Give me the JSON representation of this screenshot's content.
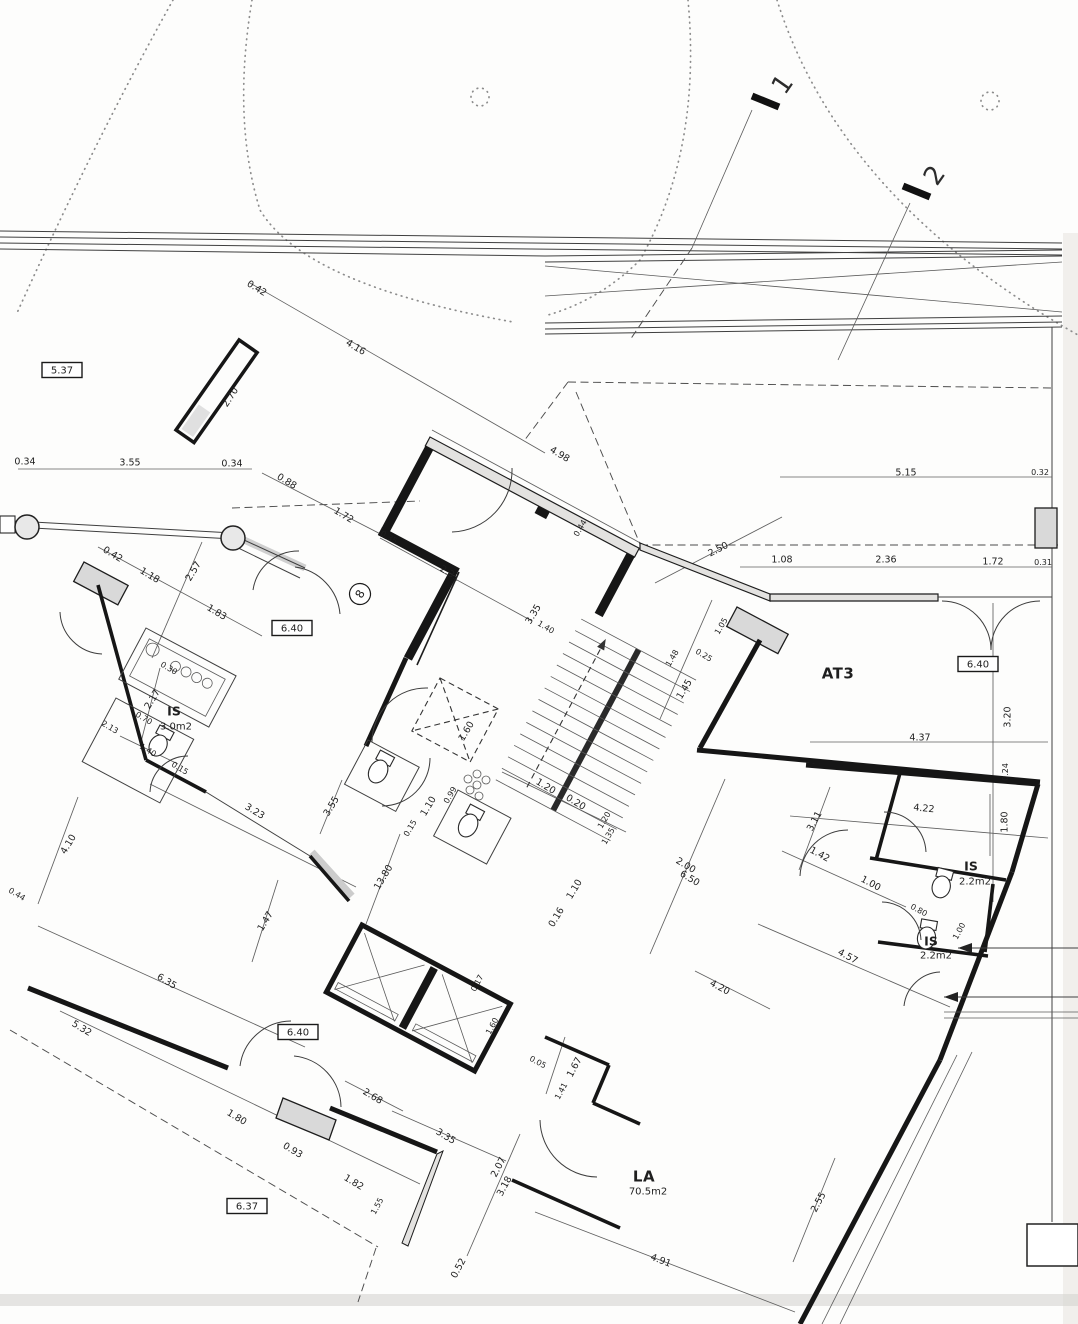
{
  "document": {
    "kind": "scanned architectural floor plan",
    "sheet_note": "rotated building plan with dimension chains in meters"
  },
  "rooms": [
    {
      "name": "AT3",
      "area": ""
    },
    {
      "name": "LA",
      "area": "70.5m2"
    },
    {
      "name": "IS",
      "area": "3.0m2"
    },
    {
      "name": "IS",
      "area": "2.2m2"
    },
    {
      "name": "IS",
      "area": "2.2m2"
    }
  ],
  "level_markers": [
    "5.37",
    "6.40",
    "6.40",
    "6.40",
    "6.37"
  ],
  "section_markers": [
    "1",
    "2"
  ],
  "grid_bubbles": [
    "8"
  ],
  "label_styles": {
    "d": {
      "cls": "lbl-d"
    },
    "ds": {
      "cls": "lbl-ds"
    },
    "rm": {
      "cls": "lbl-rm"
    },
    "rm2": {
      "cls": "lbl-rm2"
    },
    "ar": {
      "cls": "lbl-ar"
    },
    "bx": {
      "cls": "lbl-bx",
      "box": [
        40,
        15
      ]
    },
    "mk": {
      "cls": "lbl-mk"
    },
    "bb": {
      "cls": "lbl-bb",
      "circle": 10.5
    }
  },
  "labels": [
    {
      "t": "5.37",
      "x": 62,
      "y": 370,
      "r": 0,
      "s": "bx",
      "n": "level-label"
    },
    {
      "t": "0.42",
      "x": 257,
      "y": 288,
      "r": 31,
      "s": "d",
      "n": "dim-label"
    },
    {
      "t": "4.16",
      "x": 356,
      "y": 347,
      "r": 31,
      "s": "d",
      "n": "dim-label"
    },
    {
      "t": "2.70",
      "x": 230,
      "y": 397,
      "r": -57,
      "s": "d",
      "n": "dim-label"
    },
    {
      "t": "1",
      "x": 782,
      "y": 84,
      "r": -55,
      "s": "mk",
      "n": "section-marker"
    },
    {
      "t": "2",
      "x": 934,
      "y": 175,
      "r": -55,
      "s": "mk",
      "n": "section-marker"
    },
    {
      "t": "0.34",
      "x": 25,
      "y": 461,
      "r": 0,
      "s": "d",
      "n": "dim-label"
    },
    {
      "t": "3.55",
      "x": 130,
      "y": 462,
      "r": 0,
      "s": "d",
      "n": "dim-label"
    },
    {
      "t": "0.34",
      "x": 232,
      "y": 463,
      "r": 0,
      "s": "d",
      "n": "dim-label"
    },
    {
      "t": "0.88",
      "x": 287,
      "y": 481,
      "r": 31,
      "s": "d",
      "n": "dim-label"
    },
    {
      "t": "1.72",
      "x": 344,
      "y": 515,
      "r": 31,
      "s": "d",
      "n": "dim-label"
    },
    {
      "t": "0.35",
      "x": 389,
      "y": 537,
      "r": 31,
      "s": "ds",
      "n": "dim-label"
    },
    {
      "t": "0.42",
      "x": 113,
      "y": 554,
      "r": 31,
      "s": "d",
      "n": "dim-label"
    },
    {
      "t": "1.18",
      "x": 150,
      "y": 575,
      "r": 31,
      "s": "d",
      "n": "dim-label"
    },
    {
      "t": "2.57",
      "x": 193,
      "y": 571,
      "r": -59,
      "s": "d",
      "n": "dim-label"
    },
    {
      "t": "1.83",
      "x": 217,
      "y": 612,
      "r": 31,
      "s": "d",
      "n": "dim-label"
    },
    {
      "t": "6.40",
      "x": 292,
      "y": 628,
      "r": 0,
      "s": "bx",
      "n": "level-label"
    },
    {
      "t": "8",
      "x": 360,
      "y": 594,
      "r": -60,
      "s": "bb",
      "n": "grid-bubble"
    },
    {
      "t": "4.98",
      "x": 560,
      "y": 454,
      "r": 31,
      "s": "d",
      "n": "dim-label"
    },
    {
      "t": "2.31",
      "x": 450,
      "y": 573,
      "r": 31,
      "s": "d",
      "n": "dim-label"
    },
    {
      "t": "0.44",
      "x": 580,
      "y": 528,
      "r": -59,
      "s": "ds",
      "n": "dim-label"
    },
    {
      "t": "3.35",
      "x": 533,
      "y": 614,
      "r": -59,
      "s": "d",
      "n": "dim-label"
    },
    {
      "t": "1.40",
      "x": 546,
      "y": 627,
      "r": 31,
      "s": "ds",
      "n": "dim-label"
    },
    {
      "t": "2.50",
      "x": 718,
      "y": 549,
      "r": -27,
      "s": "d",
      "n": "dim-label"
    },
    {
      "t": "5.15",
      "x": 906,
      "y": 472,
      "r": 0,
      "s": "d",
      "n": "dim-label"
    },
    {
      "t": "0.32",
      "x": 1040,
      "y": 472,
      "r": 0,
      "s": "ds",
      "n": "dim-label"
    },
    {
      "t": "1.08",
      "x": 782,
      "y": 559,
      "r": 0,
      "s": "d",
      "n": "dim-label"
    },
    {
      "t": "2.36",
      "x": 886,
      "y": 559,
      "r": 0,
      "s": "d",
      "n": "dim-label"
    },
    {
      "t": "1.72",
      "x": 993,
      "y": 561,
      "r": 0,
      "s": "d",
      "n": "dim-label"
    },
    {
      "t": "0.31",
      "x": 1043,
      "y": 562,
      "r": 0,
      "s": "ds",
      "n": "dim-label"
    },
    {
      "t": "1.05",
      "x": 721,
      "y": 626,
      "r": -59,
      "s": "ds",
      "n": "dim-label"
    },
    {
      "t": "0.25",
      "x": 704,
      "y": 655,
      "r": 31,
      "s": "ds",
      "n": "dim-label"
    },
    {
      "t": "1.45",
      "x": 684,
      "y": 689,
      "r": -59,
      "s": "d",
      "n": "dim-label"
    },
    {
      "t": "AT3",
      "x": 838,
      "y": 673,
      "r": 0,
      "s": "rm",
      "n": "room-label"
    },
    {
      "t": "6.40",
      "x": 978,
      "y": 664,
      "r": 0,
      "s": "bx",
      "n": "level-label"
    },
    {
      "t": "3.20",
      "x": 1007,
      "y": 717,
      "r": -90,
      "s": "d",
      "n": "dim-label"
    },
    {
      "t": "4.37",
      "x": 920,
      "y": 737,
      "r": 0,
      "s": "d",
      "n": "dim-label"
    },
    {
      "t": "0.24",
      "x": 1005,
      "y": 772,
      "r": -90,
      "s": "ds",
      "n": "dim-label"
    },
    {
      "t": "1.60",
      "x": 466,
      "y": 731,
      "r": -59,
      "s": "d",
      "n": "dim-label"
    },
    {
      "t": "1.20",
      "x": 546,
      "y": 786,
      "r": 31,
      "s": "d",
      "n": "dim-label"
    },
    {
      "t": "0.20",
      "x": 576,
      "y": 802,
      "r": 31,
      "s": "d",
      "n": "dim-label"
    },
    {
      "t": "1.10",
      "x": 428,
      "y": 806,
      "r": -59,
      "s": "d",
      "n": "dim-label"
    },
    {
      "t": "0.99",
      "x": 450,
      "y": 795,
      "r": -59,
      "s": "ds",
      "n": "dim-label"
    },
    {
      "t": "0.15",
      "x": 410,
      "y": 828,
      "r": -59,
      "s": "ds",
      "n": "dim-label"
    },
    {
      "t": "1.20",
      "x": 604,
      "y": 820,
      "r": -59,
      "s": "ds",
      "n": "dim-label"
    },
    {
      "t": "1.35",
      "x": 608,
      "y": 836,
      "r": -59,
      "s": "ds",
      "n": "dim-label"
    },
    {
      "t": "0.16",
      "x": 556,
      "y": 917,
      "r": -59,
      "s": "d",
      "n": "dim-label"
    },
    {
      "t": "1.10",
      "x": 574,
      "y": 889,
      "r": -59,
      "s": "d",
      "n": "dim-label"
    },
    {
      "t": "2.00",
      "x": 686,
      "y": 865,
      "r": 31,
      "s": "d",
      "n": "dim-label"
    },
    {
      "t": "6.50",
      "x": 690,
      "y": 878,
      "r": 31,
      "s": "d",
      "n": "dim-label"
    },
    {
      "t": "13.80",
      "x": 383,
      "y": 877,
      "r": -59,
      "s": "d",
      "n": "dim-label"
    },
    {
      "t": "2.17",
      "x": 152,
      "y": 699,
      "r": -59,
      "s": "d",
      "n": "dim-label"
    },
    {
      "t": "0.70",
      "x": 144,
      "y": 718,
      "r": 31,
      "s": "ds",
      "n": "dim-label"
    },
    {
      "t": "IS",
      "x": 174,
      "y": 711,
      "r": 0,
      "s": "rm2",
      "n": "room-label"
    },
    {
      "t": "3.0m2",
      "x": 176,
      "y": 726,
      "r": 0,
      "s": "ar",
      "n": "room-area-label"
    },
    {
      "t": "1.40",
      "x": 148,
      "y": 750,
      "r": 31,
      "s": "ds",
      "n": "dim-label"
    },
    {
      "t": "2.13",
      "x": 110,
      "y": 727,
      "r": 31,
      "s": "ds",
      "n": "dim-label"
    },
    {
      "t": "0.30",
      "x": 169,
      "y": 668,
      "r": 31,
      "s": "ds",
      "n": "dim-label"
    },
    {
      "t": "0.15",
      "x": 180,
      "y": 768,
      "r": 31,
      "s": "ds",
      "n": "dim-label"
    },
    {
      "t": "4.10",
      "x": 68,
      "y": 844,
      "r": -59,
      "s": "d",
      "n": "dim-label"
    },
    {
      "t": "3.23",
      "x": 255,
      "y": 811,
      "r": 31,
      "s": "d",
      "n": "dim-label"
    },
    {
      "t": "3.55",
      "x": 331,
      "y": 806,
      "r": -59,
      "s": "d",
      "n": "dim-label"
    },
    {
      "t": "1.47",
      "x": 265,
      "y": 921,
      "r": -59,
      "s": "d",
      "n": "dim-label"
    },
    {
      "t": "6.35",
      "x": 167,
      "y": 981,
      "r": 31,
      "s": "d",
      "n": "dim-label"
    },
    {
      "t": "0.44",
      "x": 17,
      "y": 894,
      "r": 31,
      "s": "ds",
      "n": "dim-label"
    },
    {
      "t": "4.22",
      "x": 924,
      "y": 808,
      "r": 6,
      "s": "d",
      "n": "dim-label"
    },
    {
      "t": "3.11",
      "x": 814,
      "y": 821,
      "r": -62,
      "s": "d",
      "n": "dim-label"
    },
    {
      "t": "1.80",
      "x": 1004,
      "y": 822,
      "r": -90,
      "s": "d",
      "n": "dim-label"
    },
    {
      "t": "1.42",
      "x": 820,
      "y": 854,
      "r": 28,
      "s": "d",
      "n": "dim-label"
    },
    {
      "t": "1.00",
      "x": 871,
      "y": 883,
      "r": 28,
      "s": "d",
      "n": "dim-label"
    },
    {
      "t": "IS",
      "x": 971,
      "y": 866,
      "r": 0,
      "s": "rm2",
      "n": "room-label"
    },
    {
      "t": "2.2m2",
      "x": 975,
      "y": 881,
      "r": 0,
      "s": "ar",
      "n": "room-area-label"
    },
    {
      "t": "0.80",
      "x": 919,
      "y": 910,
      "r": 28,
      "s": "ds",
      "n": "dim-label"
    },
    {
      "t": "IS",
      "x": 931,
      "y": 941,
      "r": 0,
      "s": "rm2",
      "n": "room-label"
    },
    {
      "t": "2.2m2",
      "x": 936,
      "y": 955,
      "r": 0,
      "s": "ar",
      "n": "room-area-label"
    },
    {
      "t": "1.00",
      "x": 959,
      "y": 931,
      "r": -62,
      "s": "ds",
      "n": "dim-label"
    },
    {
      "t": "4.57",
      "x": 848,
      "y": 956,
      "r": 28,
      "s": "d",
      "n": "dim-label"
    },
    {
      "t": "2.55",
      "x": 818,
      "y": 1202,
      "r": -62,
      "s": "d",
      "n": "dim-label"
    },
    {
      "t": "4.20",
      "x": 720,
      "y": 987,
      "r": 28,
      "s": "d",
      "n": "dim-label"
    },
    {
      "t": "6.40",
      "x": 298,
      "y": 1032,
      "r": 0,
      "s": "bx",
      "n": "level-label"
    },
    {
      "t": "5.32",
      "x": 82,
      "y": 1028,
      "r": 31,
      "s": "d",
      "n": "dim-label"
    },
    {
      "t": "2.68",
      "x": 373,
      "y": 1096,
      "r": 31,
      "s": "d",
      "n": "dim-label"
    },
    {
      "t": "1.80",
      "x": 237,
      "y": 1117,
      "r": 31,
      "s": "d",
      "n": "dim-label"
    },
    {
      "t": "0.93",
      "x": 293,
      "y": 1150,
      "r": 31,
      "s": "d",
      "n": "dim-label"
    },
    {
      "t": "1.82",
      "x": 354,
      "y": 1182,
      "r": 31,
      "s": "d",
      "n": "dim-label"
    },
    {
      "t": "6.37",
      "x": 247,
      "y": 1206,
      "r": 0,
      "s": "bx",
      "n": "level-label"
    },
    {
      "t": "1.55",
      "x": 377,
      "y": 1206,
      "r": -62,
      "s": "ds",
      "n": "dim-label"
    },
    {
      "t": "3.35",
      "x": 446,
      "y": 1136,
      "r": 31,
      "s": "d",
      "n": "dim-label"
    },
    {
      "t": "2.07",
      "x": 498,
      "y": 1167,
      "r": -62,
      "s": "d",
      "n": "dim-label"
    },
    {
      "t": "3.18",
      "x": 504,
      "y": 1186,
      "r": -62,
      "s": "d",
      "n": "dim-label"
    },
    {
      "t": "0.52",
      "x": 458,
      "y": 1268,
      "r": -62,
      "s": "d",
      "n": "dim-label"
    },
    {
      "t": "4.91",
      "x": 661,
      "y": 1260,
      "r": 21,
      "s": "d",
      "n": "dim-label"
    },
    {
      "t": "LA",
      "x": 644,
      "y": 1176,
      "r": 0,
      "s": "rm",
      "n": "room-label"
    },
    {
      "t": "70.5m2",
      "x": 648,
      "y": 1191,
      "r": 0,
      "s": "ar",
      "n": "room-area-label"
    },
    {
      "t": "1.67",
      "x": 574,
      "y": 1067,
      "r": -62,
      "s": "d",
      "n": "dim-label"
    },
    {
      "t": "0.05",
      "x": 538,
      "y": 1062,
      "r": 28,
      "s": "ds",
      "n": "dim-label"
    },
    {
      "t": "1.60",
      "x": 492,
      "y": 1026,
      "r": -62,
      "s": "ds",
      "n": "dim-label"
    },
    {
      "t": "0.17",
      "x": 477,
      "y": 983,
      "r": -62,
      "s": "ds",
      "n": "dim-label"
    },
    {
      "t": "1.41",
      "x": 561,
      "y": 1091,
      "r": -62,
      "s": "ds",
      "n": "dim-label"
    },
    {
      "t": "1.48",
      "x": 672,
      "y": 658,
      "r": -59,
      "s": "ds",
      "n": "dim-label"
    }
  ]
}
